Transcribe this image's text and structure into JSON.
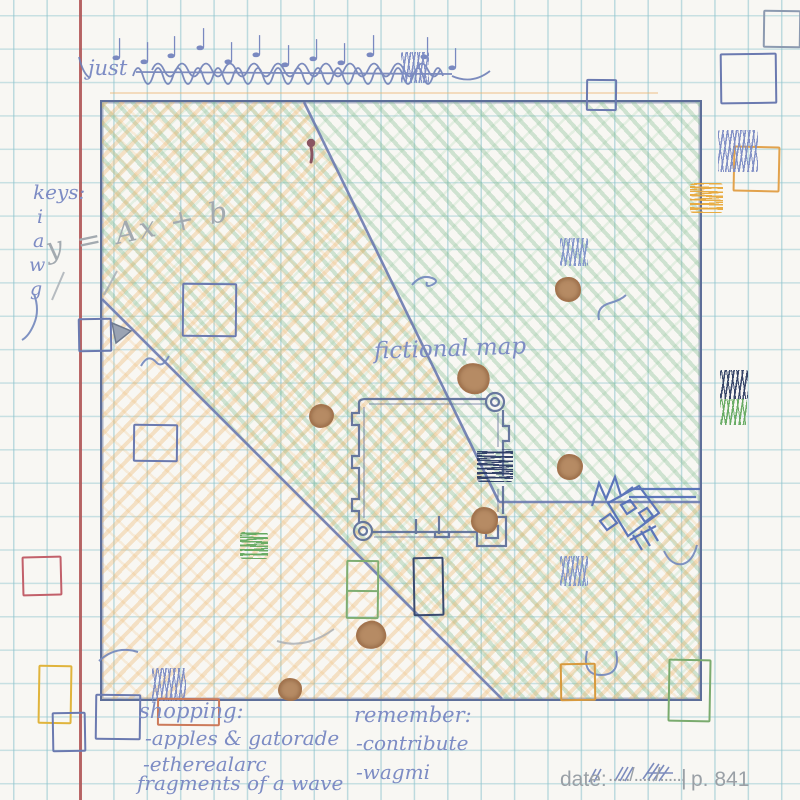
{
  "header": {
    "lead_word": "just",
    "note_glyph": "♩"
  },
  "keys": {
    "title": "keys:",
    "letters": [
      "i",
      "a",
      "w",
      "g"
    ]
  },
  "equation": {
    "text": "y = Ax + b"
  },
  "map": {
    "label": "fictional map"
  },
  "shopping": {
    "title": "shopping:",
    "items": [
      "-apples & gatorade",
      "-etherealarc",
      "fragments of a wave"
    ]
  },
  "remember": {
    "title": "remember:",
    "items": [
      "-contribute",
      "-wagmi"
    ]
  },
  "footer": {
    "date_label": "date:",
    "date_value": "...../...../......",
    "divider": "|",
    "page": "p. 841"
  },
  "colors": {
    "ink": "#7d8cc4",
    "map_line": "#5d6e99",
    "green_fill": "#7fb88a",
    "orange_fill": "#ecb46a",
    "navy": "#37466e",
    "yellow": "#ecb53d",
    "green_pen": "#63a95f",
    "red_pen": "#c2606a",
    "paper": "#f8f7f3",
    "margin_red": "#b24f4f",
    "pencil": "#a3aab0",
    "stain": "#b68b64"
  }
}
